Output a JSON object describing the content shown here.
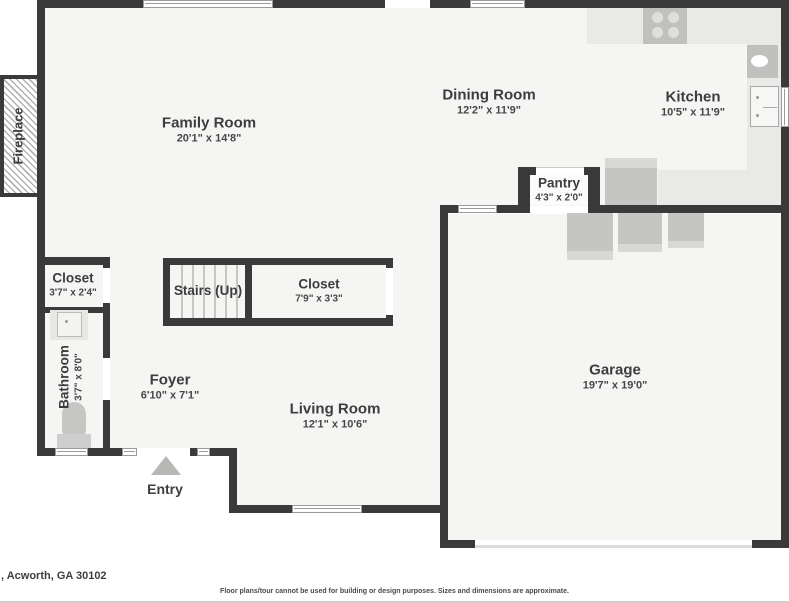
{
  "rooms": {
    "family_room": {
      "name": "Family Room",
      "dims": "20'1\" x 14'8\""
    },
    "dining_room": {
      "name": "Dining Room",
      "dims": "12'2\" x 11'9\""
    },
    "kitchen": {
      "name": "Kitchen",
      "dims": "10'5\" x 11'9\""
    },
    "pantry": {
      "name": "Pantry",
      "dims": "4'3\" x 2'0\""
    },
    "closet_small": {
      "name": "Closet",
      "dims": "3'7\" x 2'4\""
    },
    "closet_long": {
      "name": "Closet",
      "dims": "7'9\" x 3'3\""
    },
    "stairs": {
      "name": "Stairs (Up)"
    },
    "bathroom": {
      "name": "Bathroom",
      "dims": "3'7\" x 8'0\""
    },
    "foyer": {
      "name": "Foyer",
      "dims": "6'10\" x 7'1\""
    },
    "living_room": {
      "name": "Living Room",
      "dims": "12'1\" x 10'6\""
    },
    "garage": {
      "name": "Garage",
      "dims": "19'7\" x 19'0\""
    },
    "entry": {
      "name": "Entry"
    },
    "fireplace": {
      "name": "Fireplace"
    }
  },
  "footer": {
    "address": ", Acworth, GA 30102",
    "disclaimer": "Floor plans/tour cannot be used for building or design purposes. Sizes and dimensions are approximate."
  },
  "colors": {
    "wall": "#3a3a3a",
    "floor": "#f5f5f4",
    "counter": "#e9e9e8",
    "appliance": "#c5c5c4",
    "text": "#3d3d3d"
  }
}
